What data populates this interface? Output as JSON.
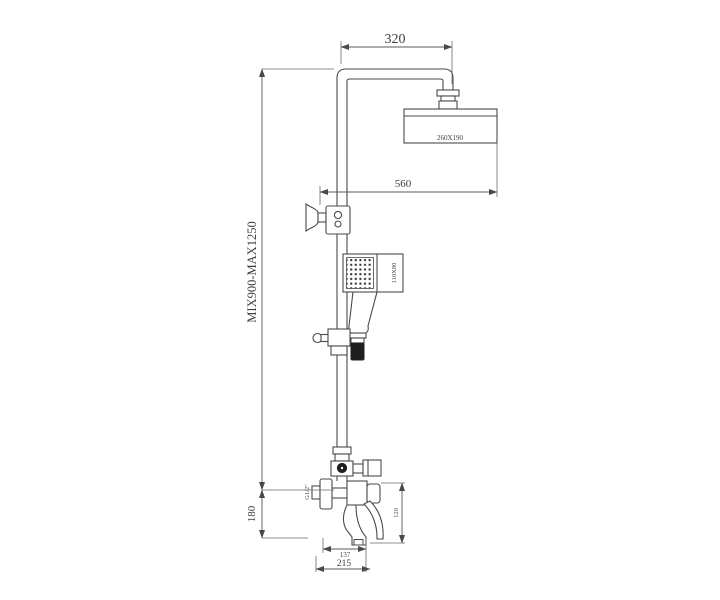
{
  "drawing": {
    "type": "technical-drawing",
    "subject": "Wall-mounted shower column with overhead rain shower, hand shower and tub spout mixer",
    "colors": {
      "background": "#ffffff",
      "line": "#4a4a4a",
      "text": "#3f3f3f",
      "dark_fill": "#1f1f1f"
    },
    "labels": {
      "arm_width": "320",
      "head_size": "260X190",
      "head_reach": "560",
      "height_range": "MIX900-MAX1250",
      "hand_shower_size": "110X80",
      "thread": "G1/2\"",
      "body_drop": "120",
      "mixer_height": "180",
      "spout_reach": "137",
      "total_reach": "215"
    }
  }
}
